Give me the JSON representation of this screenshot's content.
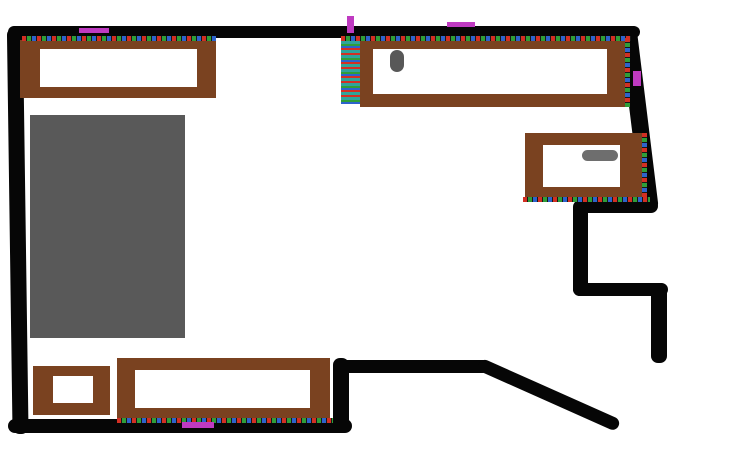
{
  "drawing": {
    "kind": "floor-plan-sketch",
    "background": "#ffffff",
    "width_px": 730,
    "height_px": 456
  },
  "colors": {
    "wall": "#060606",
    "furniture": "#7a4220",
    "furniture-fill": "#ffffff",
    "rug": "#595959",
    "knob-dark": "#585858",
    "knob-light": "#6e6e6e",
    "marker": "#bf3ac1",
    "dash-red": "#d32f23",
    "dash-green": "#2f9e38",
    "dash-blue": "#2d63cc",
    "dash-gap": "#161616",
    "stripe-teal": "#2fa49b"
  },
  "objects": [
    {
      "name": "wall-top",
      "kind": "wall",
      "shape": "horizontal thick black bar"
    },
    {
      "name": "wall-left",
      "kind": "wall",
      "shape": "slightly slanted vertical thick black bar"
    },
    {
      "name": "wall-bottom",
      "kind": "wall",
      "shape": "horizontal thick black bar"
    },
    {
      "name": "wall-step-riser",
      "kind": "wall",
      "shape": "short vertical bar right of bottom desk"
    },
    {
      "name": "wall-mid",
      "kind": "wall",
      "shape": "horizontal bar above bottom-right opening"
    },
    {
      "name": "wall-diagonal",
      "kind": "wall",
      "shape": "diagonal bar sloping down to the right"
    },
    {
      "name": "wall-right",
      "kind": "wall",
      "shape": "slightly slanted vertical bar on right"
    },
    {
      "name": "wall-nook-top",
      "kind": "wall",
      "shape": "short horizontal bar"
    },
    {
      "name": "wall-nook-left",
      "kind": "wall",
      "shape": "short vertical bar"
    },
    {
      "name": "wall-nook-bottom",
      "kind": "wall",
      "shape": "short horizontal bar"
    },
    {
      "name": "wall-nook-right",
      "kind": "wall",
      "shape": "short vertical bar"
    },
    {
      "name": "rug",
      "kind": "rug",
      "shape": "solid gray rectangle",
      "color_ref": "rug"
    },
    {
      "name": "radiator-strip",
      "kind": "striped-strip",
      "shape": "vertical strip of teal/red/green/blue stripes"
    },
    {
      "name": "desk-top-left",
      "kind": "furniture",
      "shape": "hollow brown rectangle"
    },
    {
      "name": "desk-top-right",
      "kind": "furniture",
      "shape": "hollow brown rectangle"
    },
    {
      "name": "cabinet-right",
      "kind": "furniture",
      "shape": "hollow brown rectangle"
    },
    {
      "name": "desk-bottom",
      "kind": "furniture",
      "shape": "hollow brown rectangle"
    },
    {
      "name": "stool-bottom-left",
      "kind": "furniture",
      "shape": "small hollow brown square"
    },
    {
      "name": "knob-desk-top-right",
      "kind": "fixture",
      "shape": "dark gray vertical oval",
      "color_ref": "knob-dark"
    },
    {
      "name": "handle-cabinet-right",
      "kind": "fixture",
      "shape": "gray horizontal oval",
      "color_ref": "knob-light"
    },
    {
      "name": "dash-desk-top-left",
      "kind": "dashed-edge",
      "shape": "red-green-blue dashed horizontal line"
    },
    {
      "name": "dash-desk-top-right",
      "kind": "dashed-edge",
      "shape": "red-green-blue dashed horizontal line"
    },
    {
      "name": "dash-desk-top-right-edge",
      "kind": "dashed-edge",
      "shape": "red-green-blue dashed vertical line"
    },
    {
      "name": "dash-cabinet-right-edge",
      "kind": "dashed-edge",
      "shape": "red-green-blue dashed vertical line"
    },
    {
      "name": "dash-cabinet-bottom",
      "kind": "dashed-edge",
      "shape": "red-green-blue dashed horizontal line"
    },
    {
      "name": "dash-desk-bottom",
      "kind": "dashed-edge",
      "shape": "red-green-blue dashed horizontal line"
    },
    {
      "name": "marker-top-left",
      "kind": "marker",
      "shape": "magenta horizontal tick",
      "color_ref": "marker"
    },
    {
      "name": "marker-top-middle",
      "kind": "marker",
      "shape": "magenta vertical tick",
      "color_ref": "marker"
    },
    {
      "name": "marker-top-right",
      "kind": "marker",
      "shape": "magenta horizontal tick",
      "color_ref": "marker"
    },
    {
      "name": "marker-right-wall",
      "kind": "marker",
      "shape": "magenta vertical tick",
      "color_ref": "marker"
    },
    {
      "name": "marker-bottom",
      "kind": "marker",
      "shape": "magenta horizontal tick",
      "color_ref": "marker"
    }
  ]
}
